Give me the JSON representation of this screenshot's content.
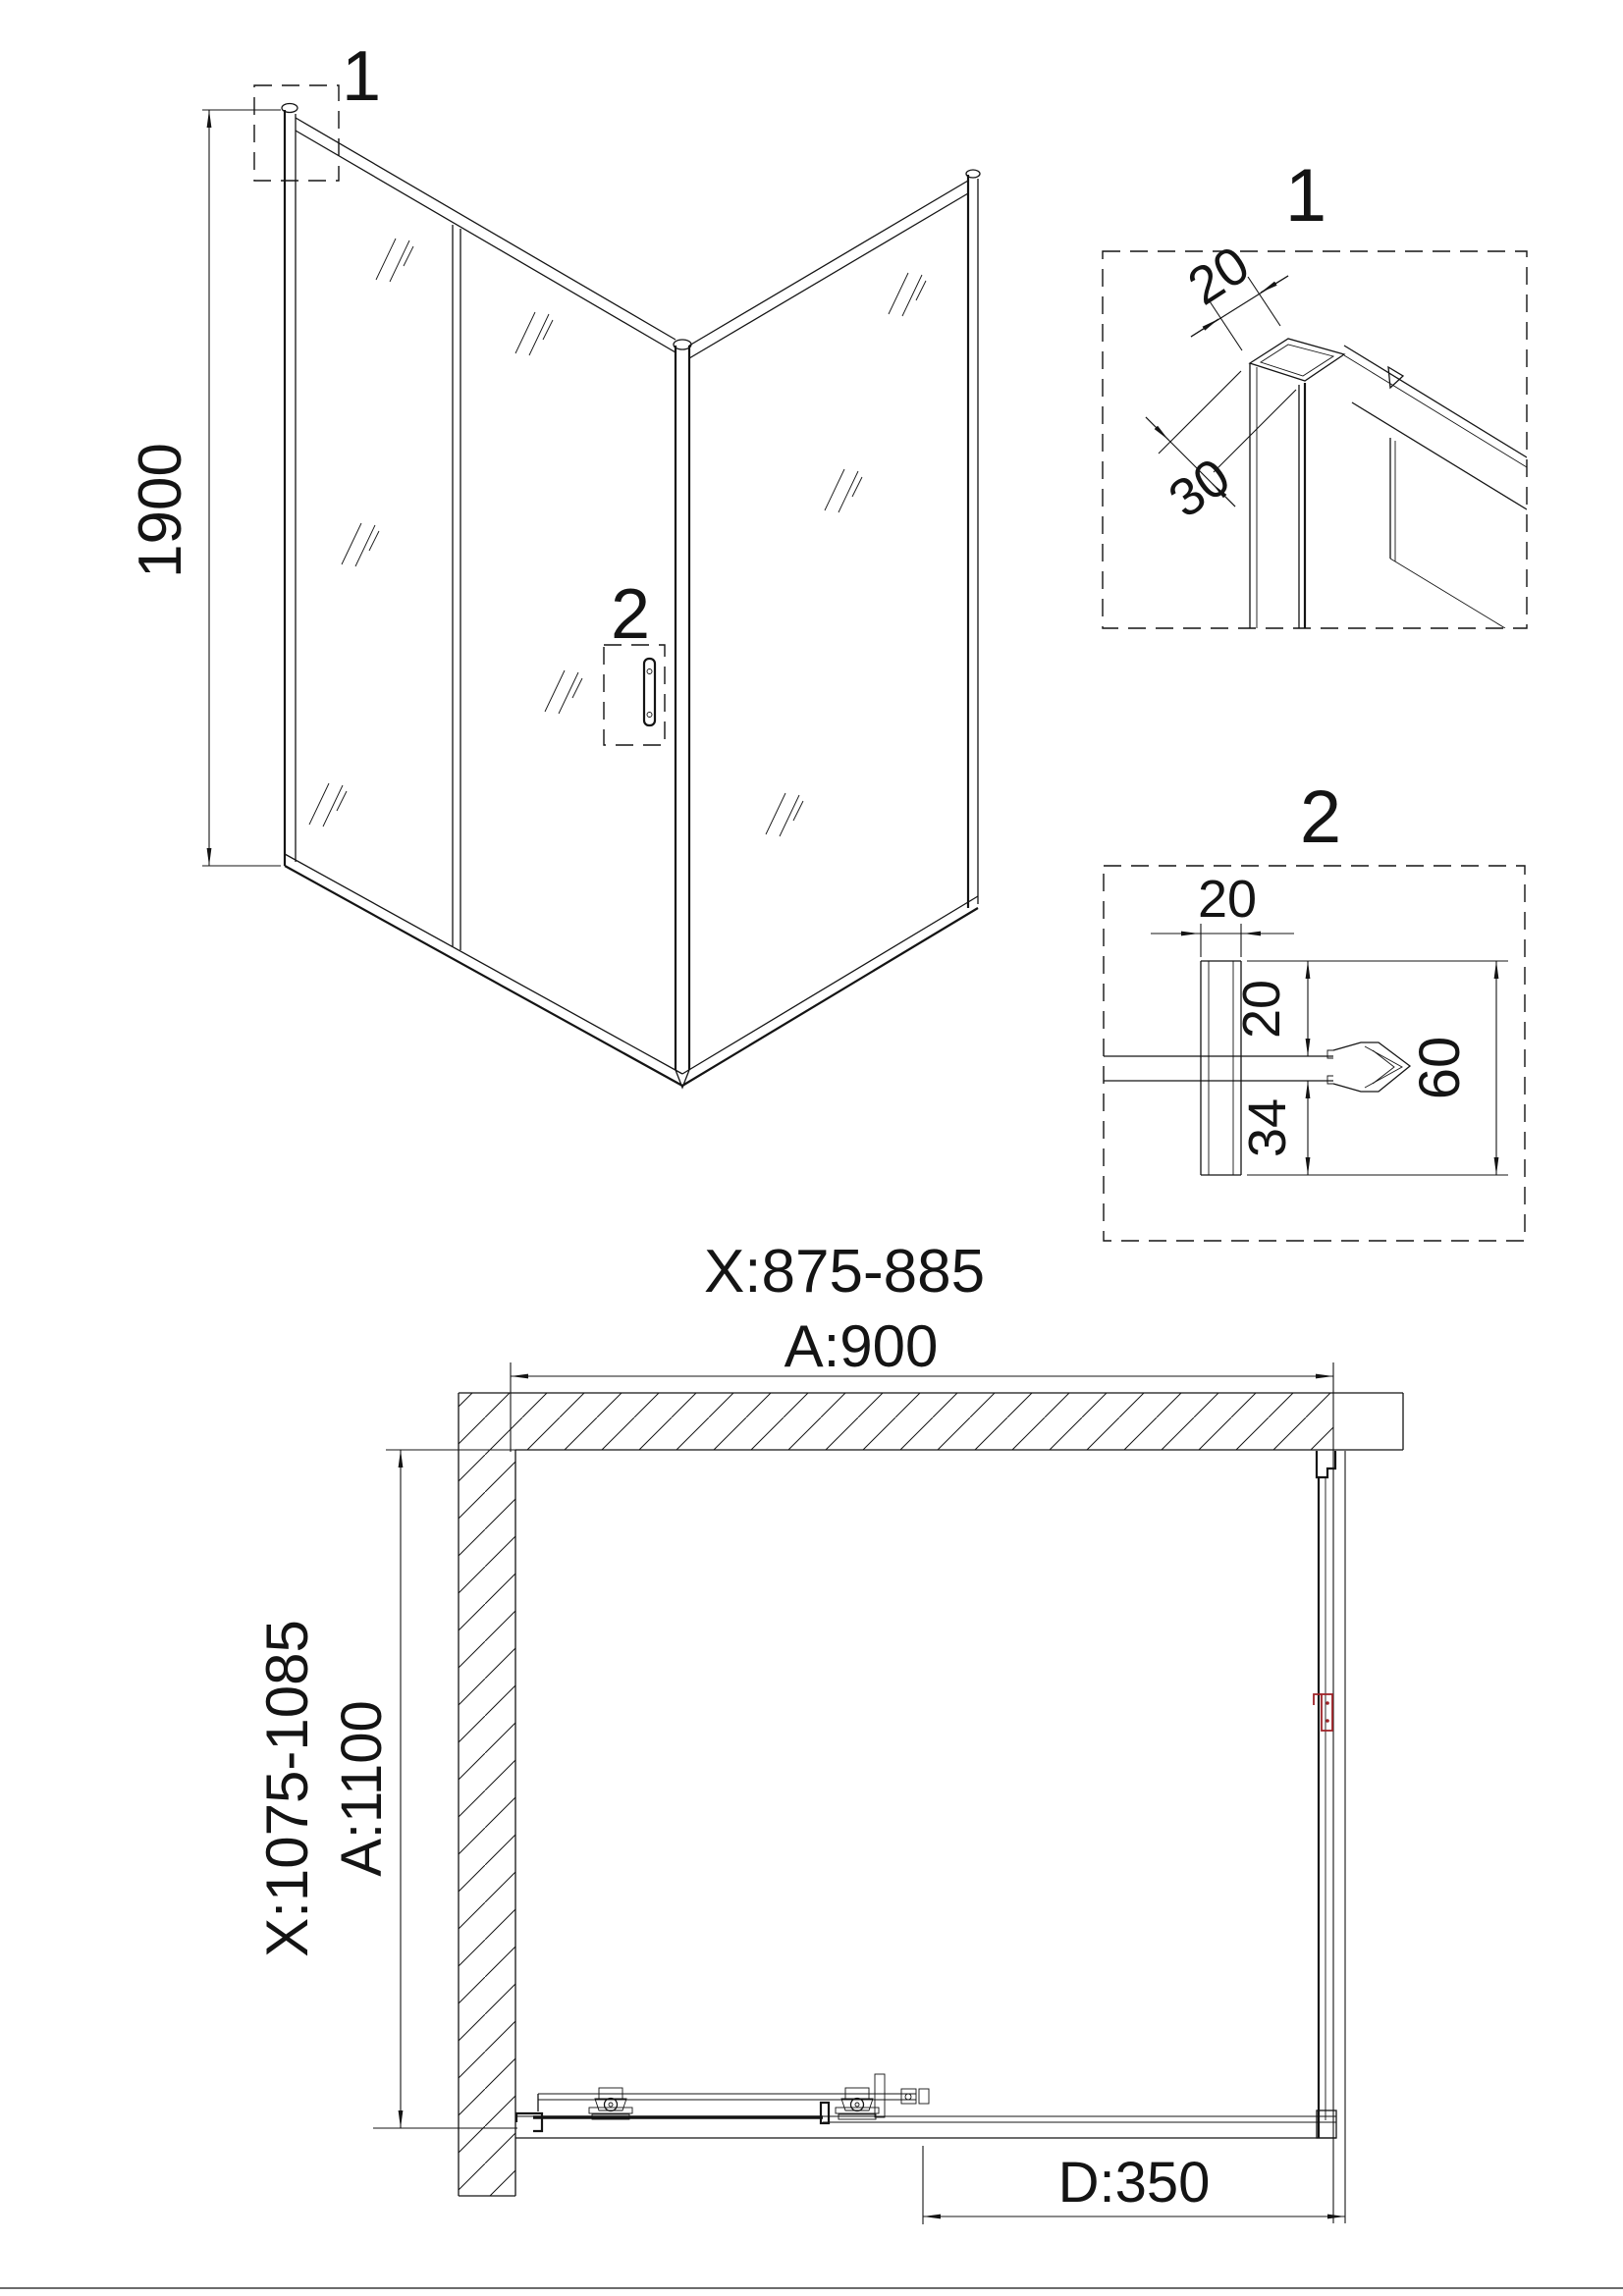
{
  "colors": {
    "background": "#ffffff",
    "line": "#141414",
    "accent_red": "#9f2328"
  },
  "iso_view": {
    "callout_top": "1",
    "callout_handle": "2",
    "height_mm": "1900"
  },
  "detail_1": {
    "label": "1",
    "profile_width_mm": "20",
    "profile_depth_mm": "30"
  },
  "detail_2": {
    "label": "2",
    "profile_width_mm": "20",
    "gap_above_glass_mm": "20",
    "gap_below_glass_mm": "34",
    "total_height_mm": "60"
  },
  "plan_view": {
    "width_adjust_range": "X:875-885",
    "width_nominal": "A:900",
    "depth_adjust_range": "X:1075-1085",
    "depth_nominal": "A:1100",
    "door_opening": "D:350"
  }
}
